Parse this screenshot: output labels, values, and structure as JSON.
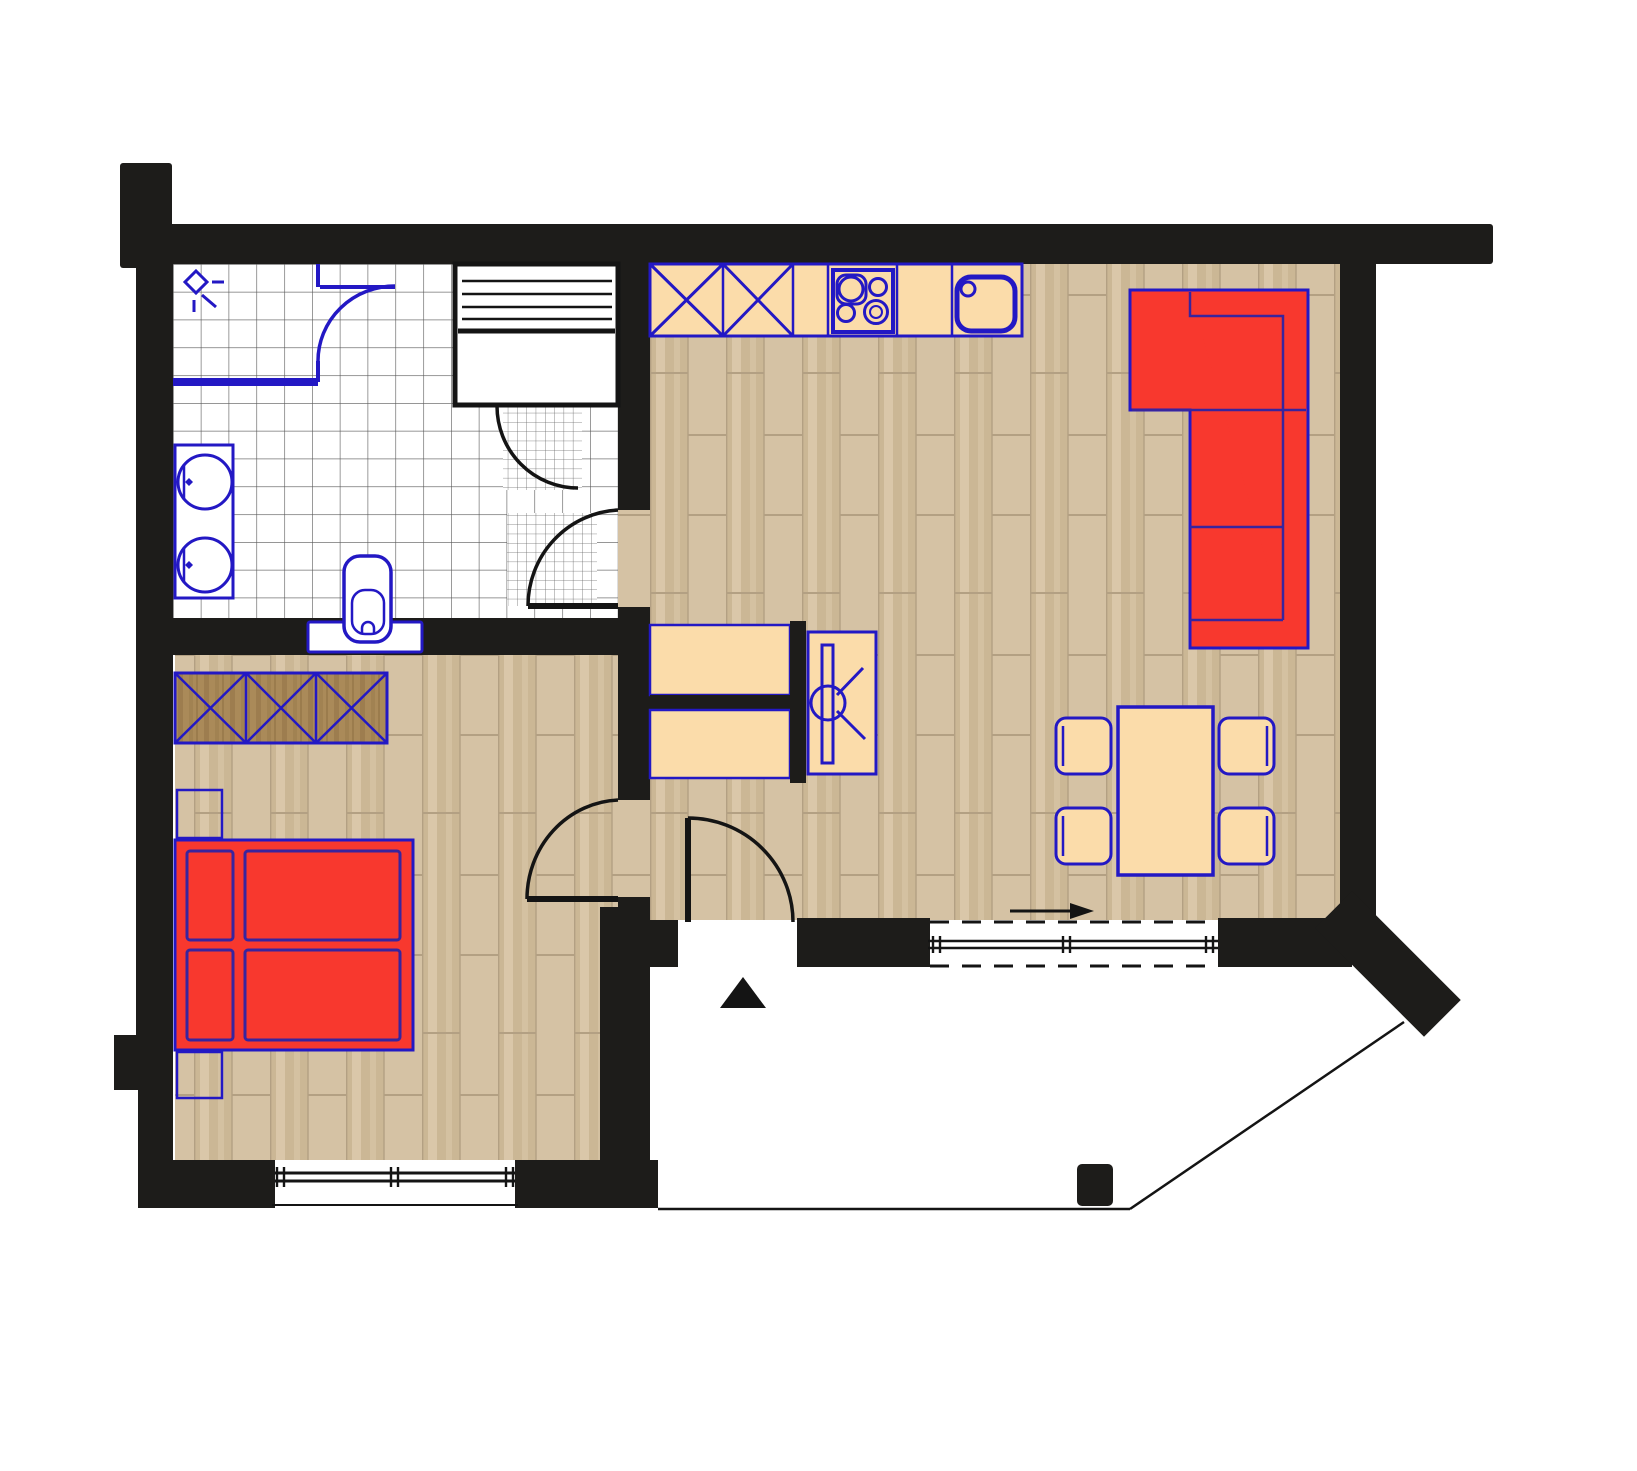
{
  "plan": {
    "kind": "apartment-floor-plan",
    "orientation": "top-down",
    "rooms": [
      {
        "id": "bathroom",
        "position": "top-left",
        "floor": "white-square-tiles",
        "features": [
          "shower-corner-with-glass-door",
          "ceiling-light-symbol",
          "sauna-cabin",
          "double-washbasin-counter",
          "toilet",
          "entry-door-swing",
          "fine-tile-wet-patches"
        ]
      },
      {
        "id": "living-room-with-kitchen",
        "position": "right",
        "floor": "wood-parquet",
        "features": [
          "kitchen-counter-row",
          "corner-sofa-red",
          "dining-table-with-four-chairs",
          "tv-sideboard",
          "sliding-terrace-door",
          "entrance-door-swing",
          "slide-direction-arrow"
        ]
      },
      {
        "id": "bedroom",
        "position": "bottom-left",
        "floor": "wood-parquet",
        "features": [
          "double-bed-red",
          "wardrobe-three-sections",
          "nightstand-top",
          "nightstand-bottom",
          "window-in-bottom-wall",
          "door-swing-to-hall"
        ]
      },
      {
        "id": "terrace",
        "position": "bottom-right",
        "floor": "white-open",
        "features": [
          "thin-boundary-line",
          "diagonal-boundary-line",
          "support-column",
          "angled-corner-wall"
        ]
      }
    ],
    "kitchen_counter_cells": [
      "cabinet-x",
      "cabinet-x",
      "cabinet-plain",
      "cooktop-4-burners",
      "cabinet-plain",
      "sink-unit"
    ],
    "symbols": {
      "entrance_marker": "black-triangle",
      "sliding_door": "double-line-with-dashed-tracks",
      "doors": "quarter-circle-swing-arcs",
      "tv": "screen-bar-with-circle-and-view-lines",
      "shower_light": "diamond-with-rays"
    },
    "counts": {
      "dining_chairs": 4,
      "washbasins": 2,
      "wardrobe_sections": 3,
      "bed_cushions": 4,
      "sofa_seats": 3
    }
  },
  "colors": {
    "paper": "#ffffff",
    "wall": "#1d1c1a",
    "ink": "#141414",
    "blue": "#2318c4",
    "bedline": "#38249e",
    "red": "#f8382e",
    "peach": "#fbdcaa",
    "wood_a": "#d5c2a4",
    "wood_b": "#cbb795",
    "wood_c": "#ddcbae",
    "wood_line": "#b3a083",
    "wardrobe_a": "#aa8a59",
    "wardrobe_b": "#97784a",
    "tile_line": "#585858",
    "fine_tile_line": "#6a6a6a"
  }
}
